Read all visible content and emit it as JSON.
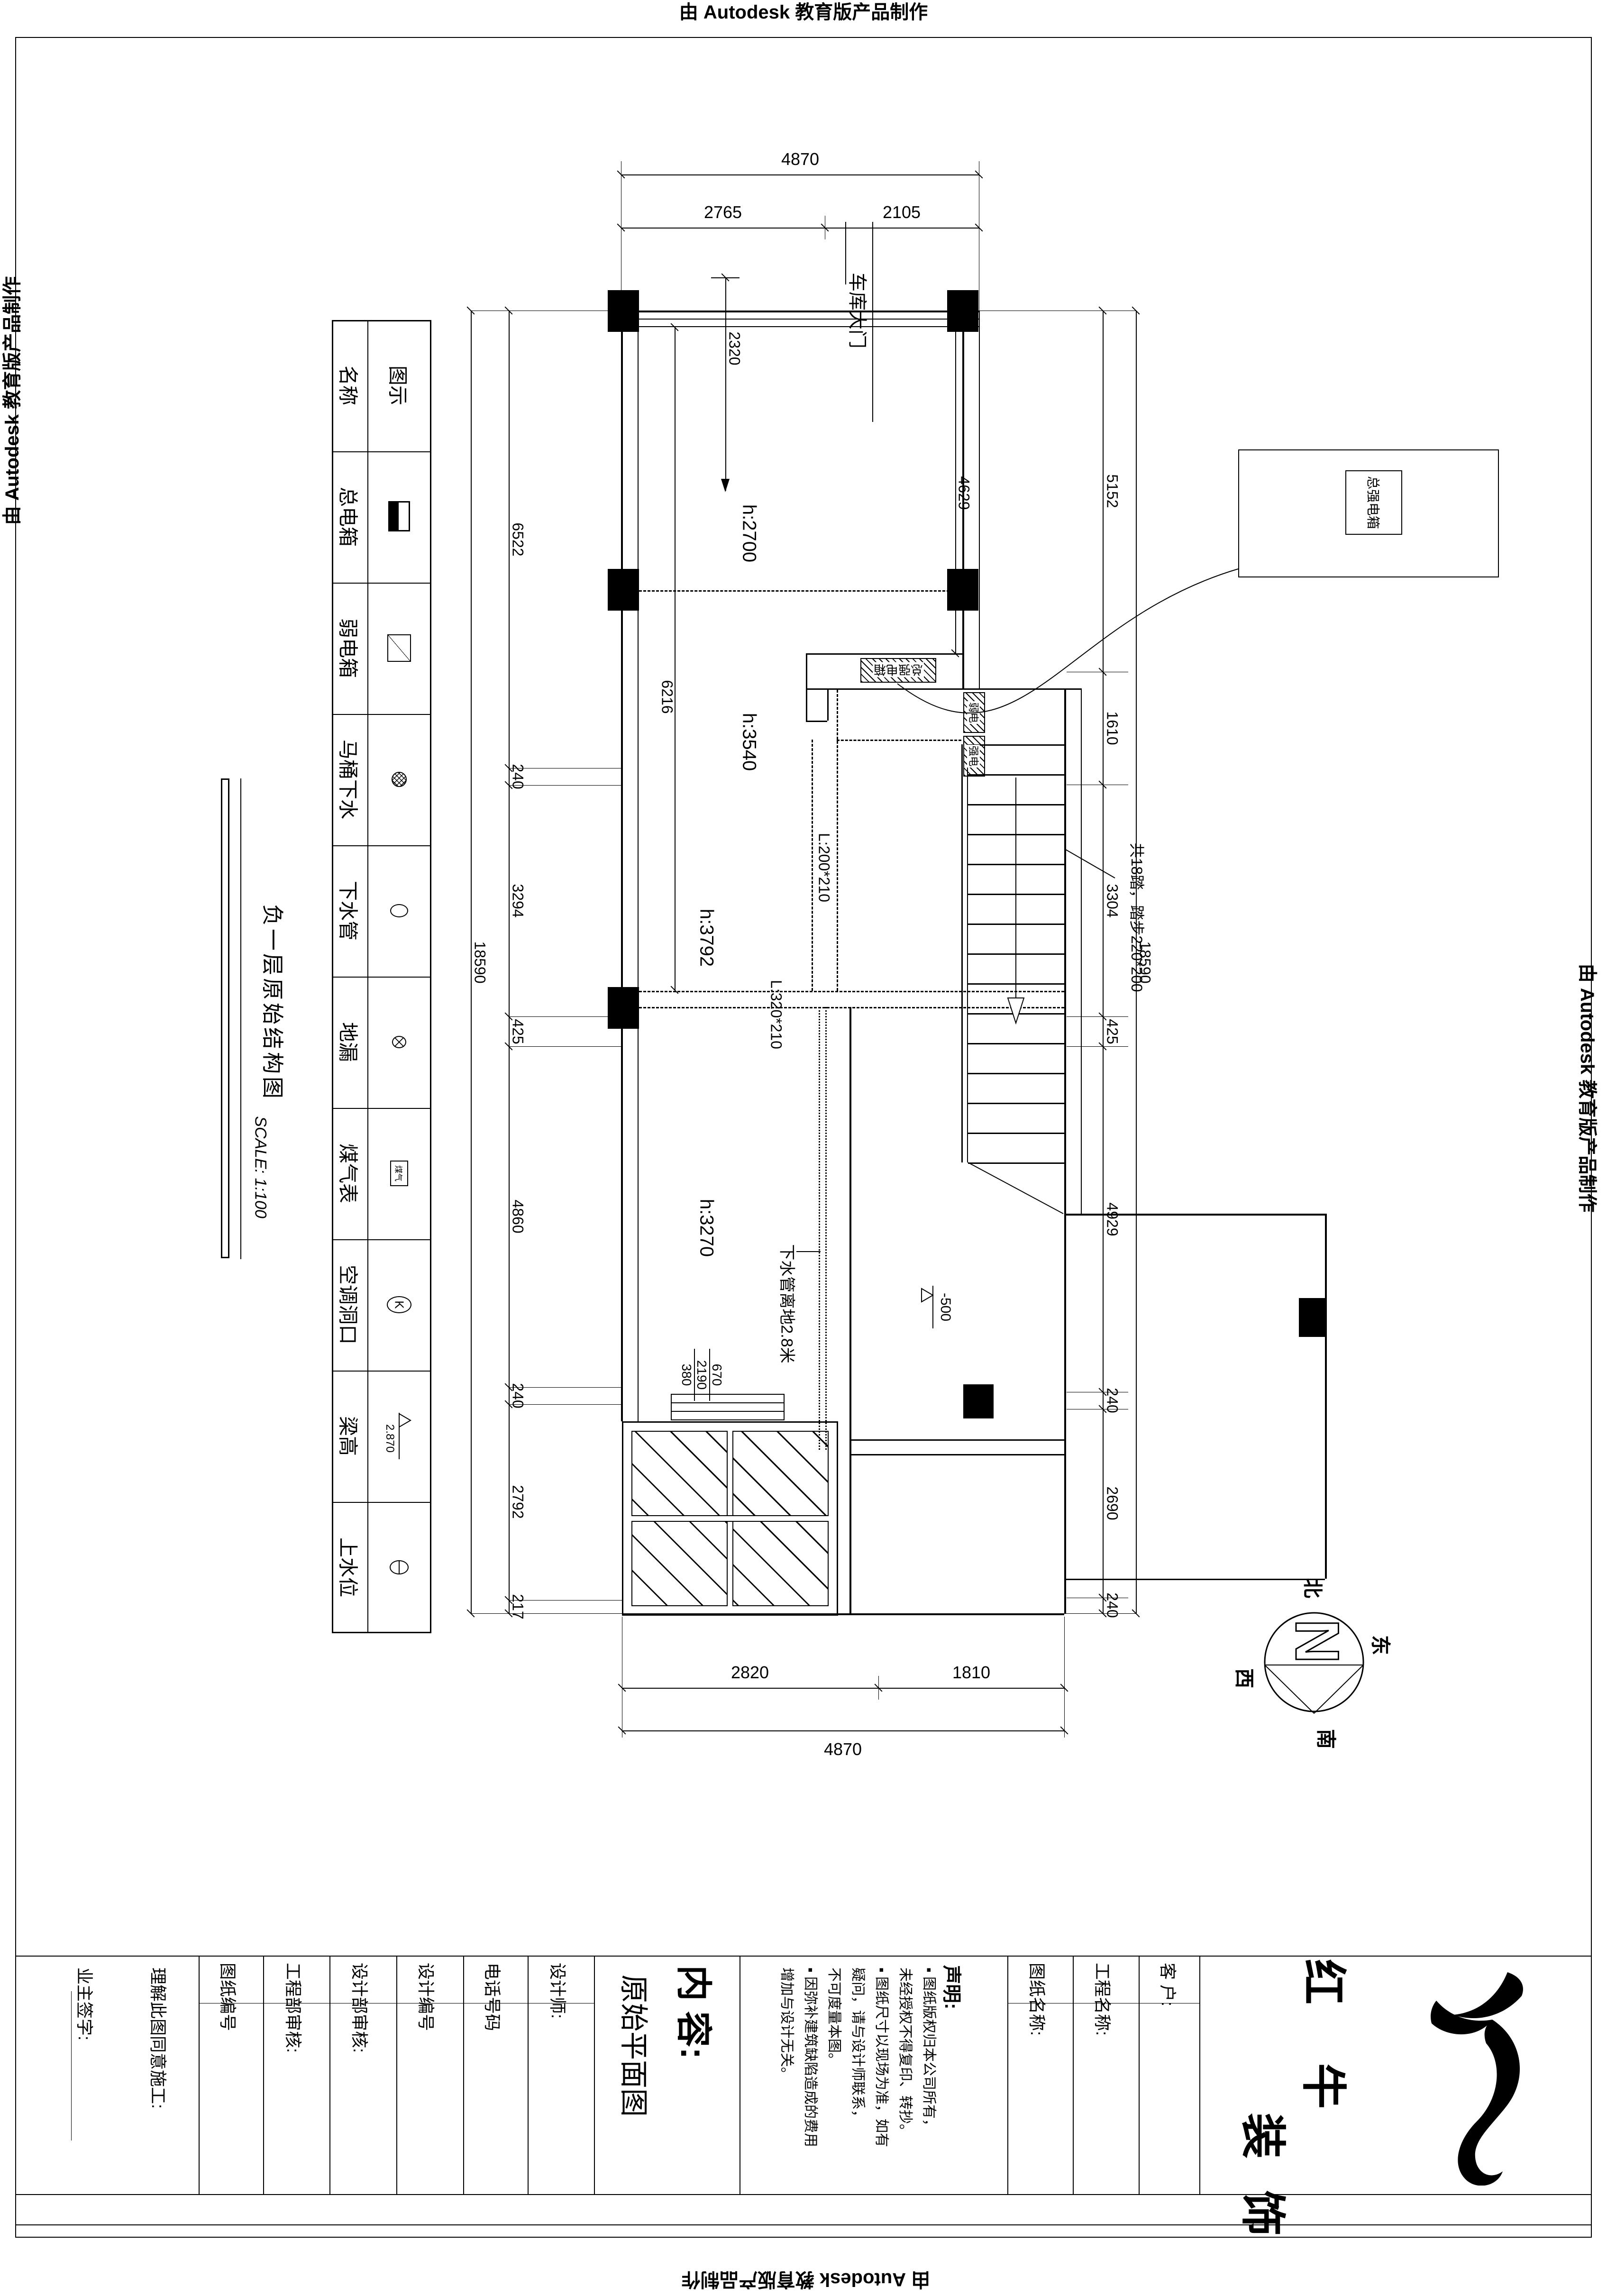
{
  "page": {
    "stamp": "由 Autodesk 教育版产品制作"
  },
  "legend": {
    "header": {
      "name": "名称",
      "symbol": "图示"
    },
    "rows": [
      {
        "name": "总电箱"
      },
      {
        "name": "弱电箱"
      },
      {
        "name": "马桶下水"
      },
      {
        "name": "下水管"
      },
      {
        "name": "地漏"
      },
      {
        "name": "煤气表",
        "sym_text": "煤气"
      },
      {
        "name": "空调洞口",
        "sym_text": "K"
      },
      {
        "name": "梁高",
        "sym_text": "2.870"
      },
      {
        "name": "上水位"
      }
    ]
  },
  "title": {
    "name": "负一层原始结构图",
    "scale": "SCALE: 1:100"
  },
  "plan": {
    "garage_door": "车库大门",
    "rooms": {
      "r1": "h:2700",
      "r2": "h:3540",
      "r3": "h:3792",
      "r4": "h:3270"
    },
    "beams": {
      "b1": "L:200*210",
      "b2": "L:320*210"
    },
    "stair_note": "共18踏，踏步220*200",
    "drain_note": "下水管离地2.8米",
    "level": "-500",
    "main_box": "总强电箱",
    "weak_box": "弱电",
    "strong_box": "强电",
    "detail_box": "总强电箱",
    "dims": {
      "top_overall": "4870",
      "top": [
        "2765",
        "2105"
      ],
      "bottom": [
        "2820",
        "1810"
      ],
      "bottom_overall": "4870",
      "left": [
        "6522",
        "240",
        "3294",
        "425",
        "4860",
        "240",
        "2792",
        "217"
      ],
      "left_overall": "18590",
      "right": [
        "5152",
        "1610",
        "3304",
        "425",
        "4929",
        "240",
        "2690",
        "240"
      ],
      "right_overall": "18590",
      "interior": {
        "d1": "2320",
        "d2": "6216",
        "d3": "4629",
        "w1": "380",
        "w2": "2190",
        "w3": "670"
      }
    }
  },
  "compass": {
    "n": "N",
    "north": "北",
    "south": "南",
    "east": "东",
    "west": "西"
  },
  "titleblock": {
    "owner_sign": "业主签字:",
    "agree": "理解此图同意施工:",
    "drawing_no": "图纸编号",
    "eng_audit": "工程部审核:",
    "design_audit": "设计部审核:",
    "design_no": "设计编号",
    "phone": "电话号码",
    "designer": "设计师:",
    "content_label": "内 容:",
    "content_value": "原始平面图",
    "statement_label": "声明:",
    "statement_lines": [
      "▪ 图纸版权归本公司所有，",
      "未经授权不得复印、转抄。",
      "▪ 图纸尺寸以现场为准，如有",
      "疑问，请与设计师联系，",
      "不可度量本图。",
      "▪ 因弥补建筑缺陷造成的费用",
      "增加与设计无关。"
    ],
    "drawing_name": "图纸名称:",
    "project_name": "工程名称:",
    "client": "客 户:",
    "brand": {
      "c1": "红",
      "c2": "牛",
      "c3": "装",
      "c4": "饰"
    }
  }
}
